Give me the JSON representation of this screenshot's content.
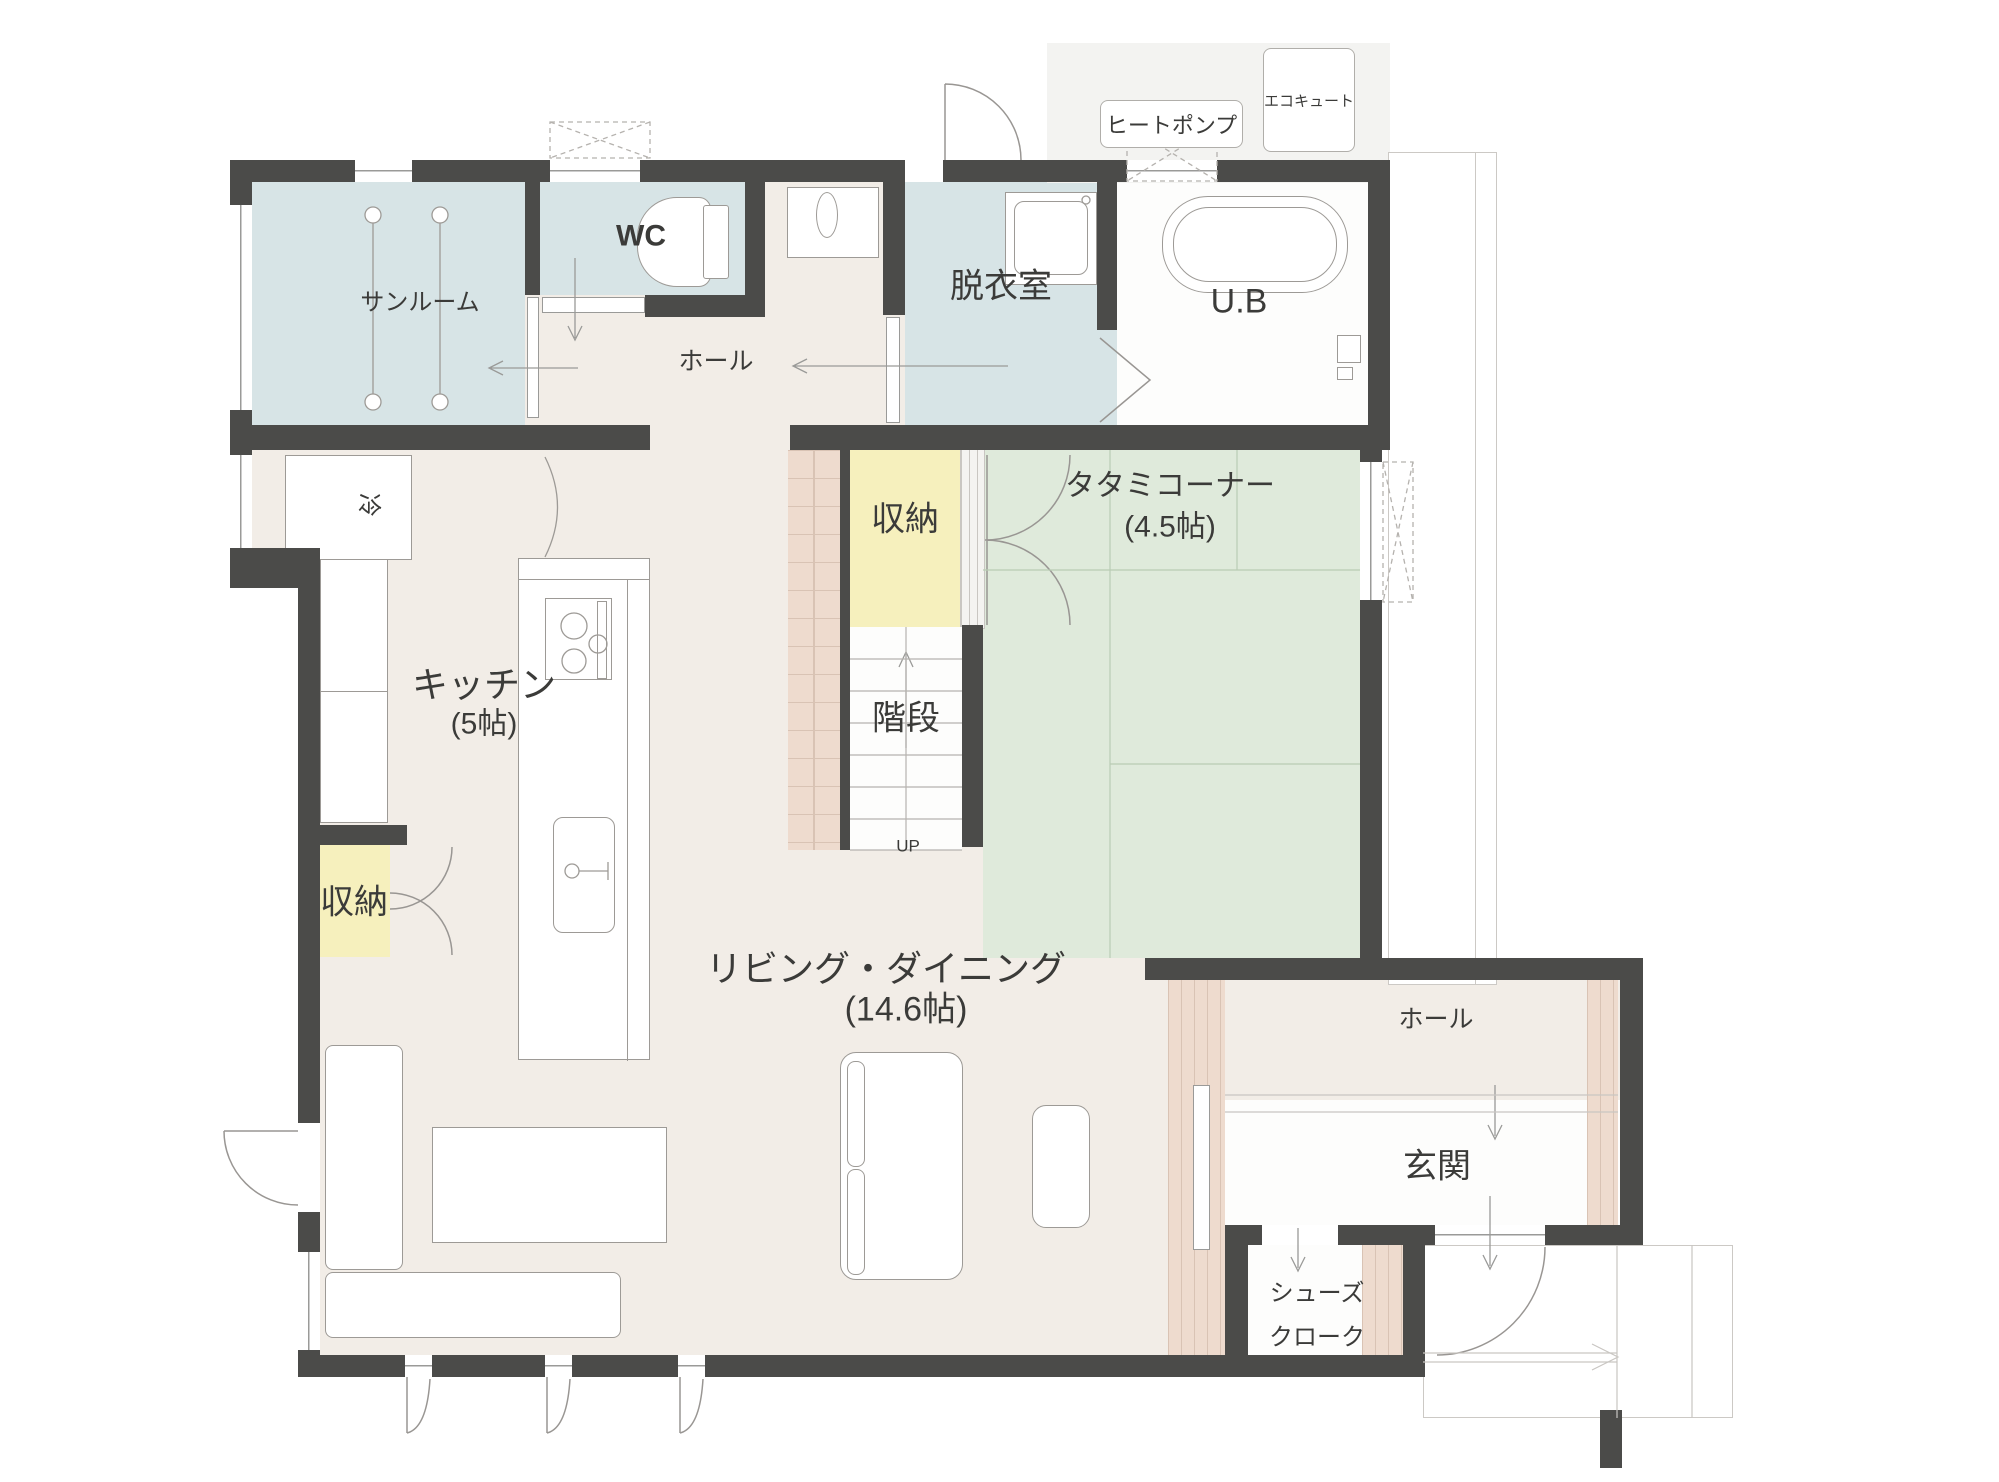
{
  "plan": {
    "rooms": {
      "sunroom": "サンルーム",
      "wc": "WC",
      "hall_top": "ホール",
      "dressing": "脱衣室",
      "bath": "U.B",
      "kitchen": "キッチン",
      "kitchen_size": "(5帖)",
      "storage_upper": "収納",
      "stairs": "階段",
      "up": "UP",
      "tatami": "タタミコーナー",
      "tatami_size": "(4.5帖)",
      "living": "リビング・ダイニング",
      "living_size": "(14.6帖)",
      "storage_lower": "収納",
      "hall_entrance": "ホール",
      "entrance": "玄関",
      "shoe_closet_line1": "シューズ",
      "shoe_closet_line2": "クローク"
    },
    "equipment": {
      "heat_pump": "ヒートポンプ",
      "ecocute": "エコキュート",
      "fridge": "冷"
    },
    "colors": {
      "wall": "#4b4b49",
      "floor_wood": "#f2ede7",
      "water_rooms": "#d7e4e6",
      "tatami": "#dfeadb",
      "storage": "#f6f0bd",
      "shelf_wood": "#eedbce"
    }
  }
}
